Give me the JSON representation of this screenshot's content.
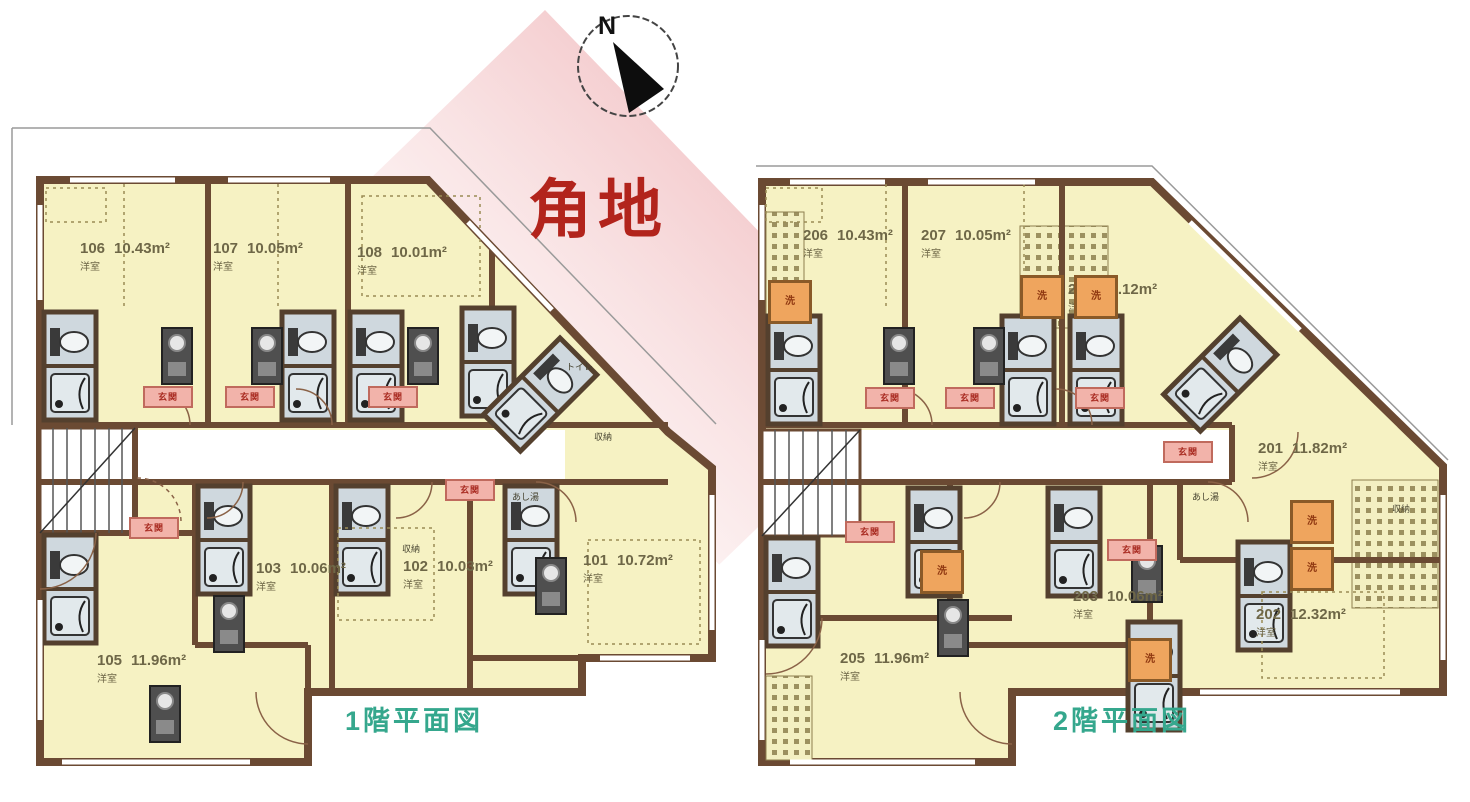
{
  "compass": {
    "north_label": "N"
  },
  "corner_banner": {
    "text": "角地"
  },
  "labels": {
    "entrance": "玄関",
    "laundry": "洗",
    "toilet": "トイレ",
    "foot_bath": "あし湯",
    "closet": "収納"
  },
  "floor1": {
    "caption": "1階平面図",
    "units": [
      {
        "id": "106",
        "area": "10.43m²",
        "type": "洋室"
      },
      {
        "id": "107",
        "area": "10.05m²",
        "type": "洋室"
      },
      {
        "id": "108",
        "area": "10.01m²",
        "type": "洋室"
      },
      {
        "id": "103",
        "area": "10.06m²",
        "type": "洋室"
      },
      {
        "id": "102",
        "area": "10.03m²",
        "type": "洋室"
      },
      {
        "id": "101",
        "area": "10.72m²",
        "type": "洋室"
      },
      {
        "id": "105",
        "area": "11.96m²",
        "type": "洋室"
      }
    ]
  },
  "floor2": {
    "caption": "2階平面図",
    "units": [
      {
        "id": "206",
        "area": "10.43m²",
        "type": "洋室"
      },
      {
        "id": "207",
        "area": "10.05m²",
        "type": "洋室"
      },
      {
        "id": "208",
        "area": "11.12m²",
        "type": "洋室"
      },
      {
        "id": "201",
        "area": "11.82m²",
        "type": "洋室"
      },
      {
        "id": "203",
        "area": "10.06m²",
        "type": "洋室"
      },
      {
        "id": "202",
        "area": "12.32m²",
        "type": "洋室"
      },
      {
        "id": "205",
        "area": "11.96m²",
        "type": "洋室"
      }
    ]
  },
  "colors": {
    "room_fill": "#f6f2c3",
    "wall": "#6b4a33",
    "bath_fill": "#cfd8de",
    "entrance_fill": "#f2b3aa",
    "laundry_fill": "#efa55e",
    "banner_red": "#b2241c",
    "caption_teal": "#35a78d",
    "band_pink": "#f5d0d2"
  }
}
